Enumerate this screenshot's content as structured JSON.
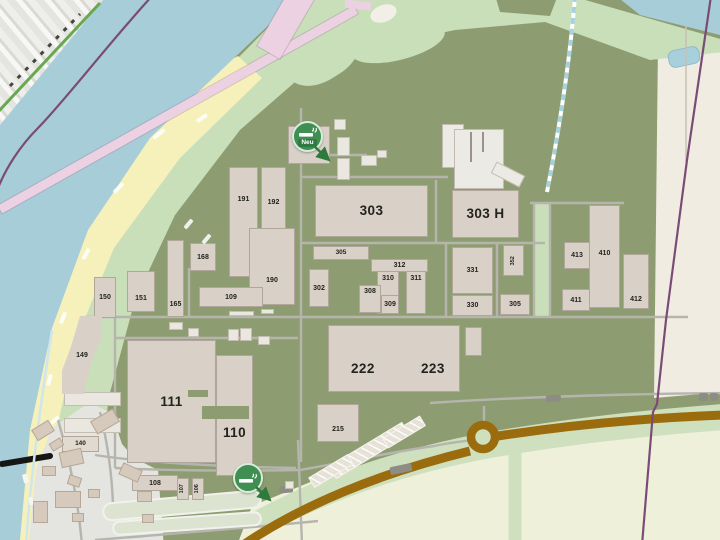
{
  "smoking_areas": [
    {
      "id": "north",
      "badge": "Neu"
    },
    {
      "id": "south",
      "badge": ""
    }
  ],
  "icons": {
    "smoking": "cigarette-icon",
    "direction": "arrow-down-right-icon"
  },
  "buildings": [
    {
      "label": "191"
    },
    {
      "label": "192"
    },
    {
      "label": "168"
    },
    {
      "label": "190"
    },
    {
      "label": "109"
    },
    {
      "label": "150"
    },
    {
      "label": "151"
    },
    {
      "label": "165"
    },
    {
      "label": "149"
    },
    {
      "label": "303"
    },
    {
      "label": "303 H"
    },
    {
      "label": "305"
    },
    {
      "label": "302"
    },
    {
      "label": "312"
    },
    {
      "label": "310"
    },
    {
      "label": "311"
    },
    {
      "label": "308"
    },
    {
      "label": "309"
    },
    {
      "label": "331"
    },
    {
      "label": "352"
    },
    {
      "label": "330"
    },
    {
      "label": "305"
    },
    {
      "label": "413"
    },
    {
      "label": "410"
    },
    {
      "label": "411"
    },
    {
      "label": "412"
    },
    {
      "label": "111"
    },
    {
      "label": "110"
    },
    {
      "label": "222"
    },
    {
      "label": "223"
    },
    {
      "label": "215"
    },
    {
      "label": "140"
    },
    {
      "label": "108"
    },
    {
      "label": "107"
    },
    {
      "label": "106"
    }
  ],
  "colors": {
    "water": "#a7cdd9",
    "sand": "#f6f0bb",
    "park_green": "#c8dfba",
    "campus_green": "#8e9d71",
    "building_fill": "#d9d1c7",
    "road_brown": "#9a6c0d",
    "boundary_purple": "#7b4b77",
    "marker_green": "#3f8f52",
    "field_beige": "#f0ece1",
    "field_cream": "#eff0da"
  }
}
